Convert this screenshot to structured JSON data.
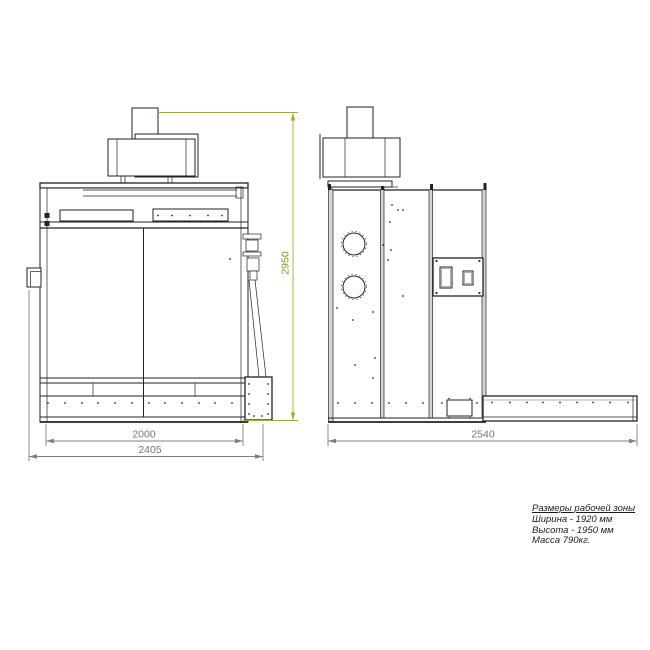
{
  "drawing": {
    "type": "technical-drawing",
    "dimensions": {
      "front_inner_width": "2000",
      "front_outer_width": "2405",
      "front_height": "2950",
      "side_depth": "2540"
    },
    "notes": {
      "title": "Размеры рабочей зоны",
      "lines": [
        "Ширина - 1920 мм",
        "Высота - 1950 мм",
        "Масса 790кг."
      ]
    },
    "colors": {
      "line": "#222222",
      "dimension_gray": "#7f7f7f",
      "dimension_olive": "#a8a832",
      "background": "#ffffff"
    }
  }
}
